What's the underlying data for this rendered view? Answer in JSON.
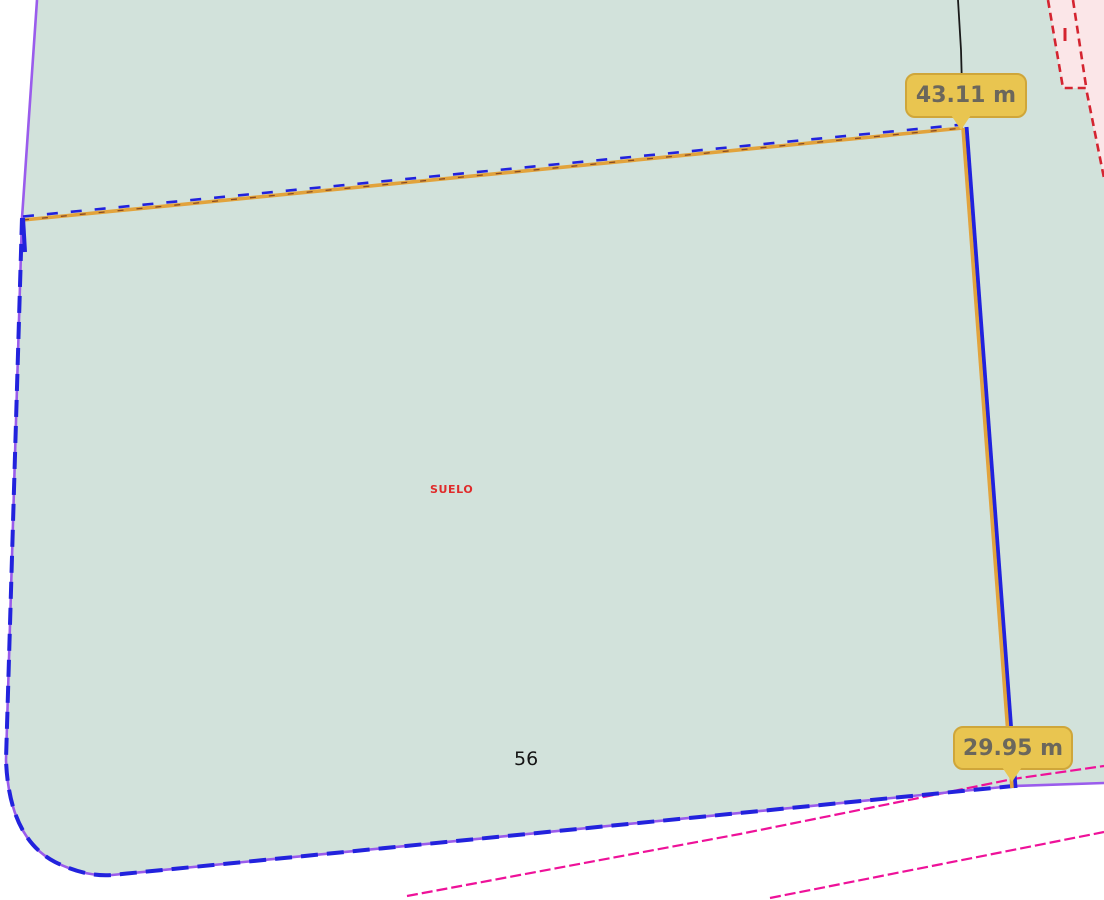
{
  "map": {
    "measurements": {
      "top_edge": "43.11 m",
      "right_edge": "29.95 m"
    },
    "texts": {
      "land_use": "SUELO",
      "parcel_number": "56"
    },
    "colors": {
      "parcel_fill": "#d2e2db",
      "adjacent_fill": "#fbe6e8",
      "boundary_violet": "#9a5cec",
      "boundary_blue": "#2222dd",
      "measure_orange": "#e2a33c",
      "measure_inner_dash": "#7a3b1e",
      "red_line": "#d42430",
      "magenta_line": "#ee1199",
      "black_line": "#1a1a1a",
      "label_bg": "#e9c550",
      "label_border": "#cfa63a",
      "label_text": "#6b675c",
      "suelo_text": "#e02b2b"
    }
  }
}
